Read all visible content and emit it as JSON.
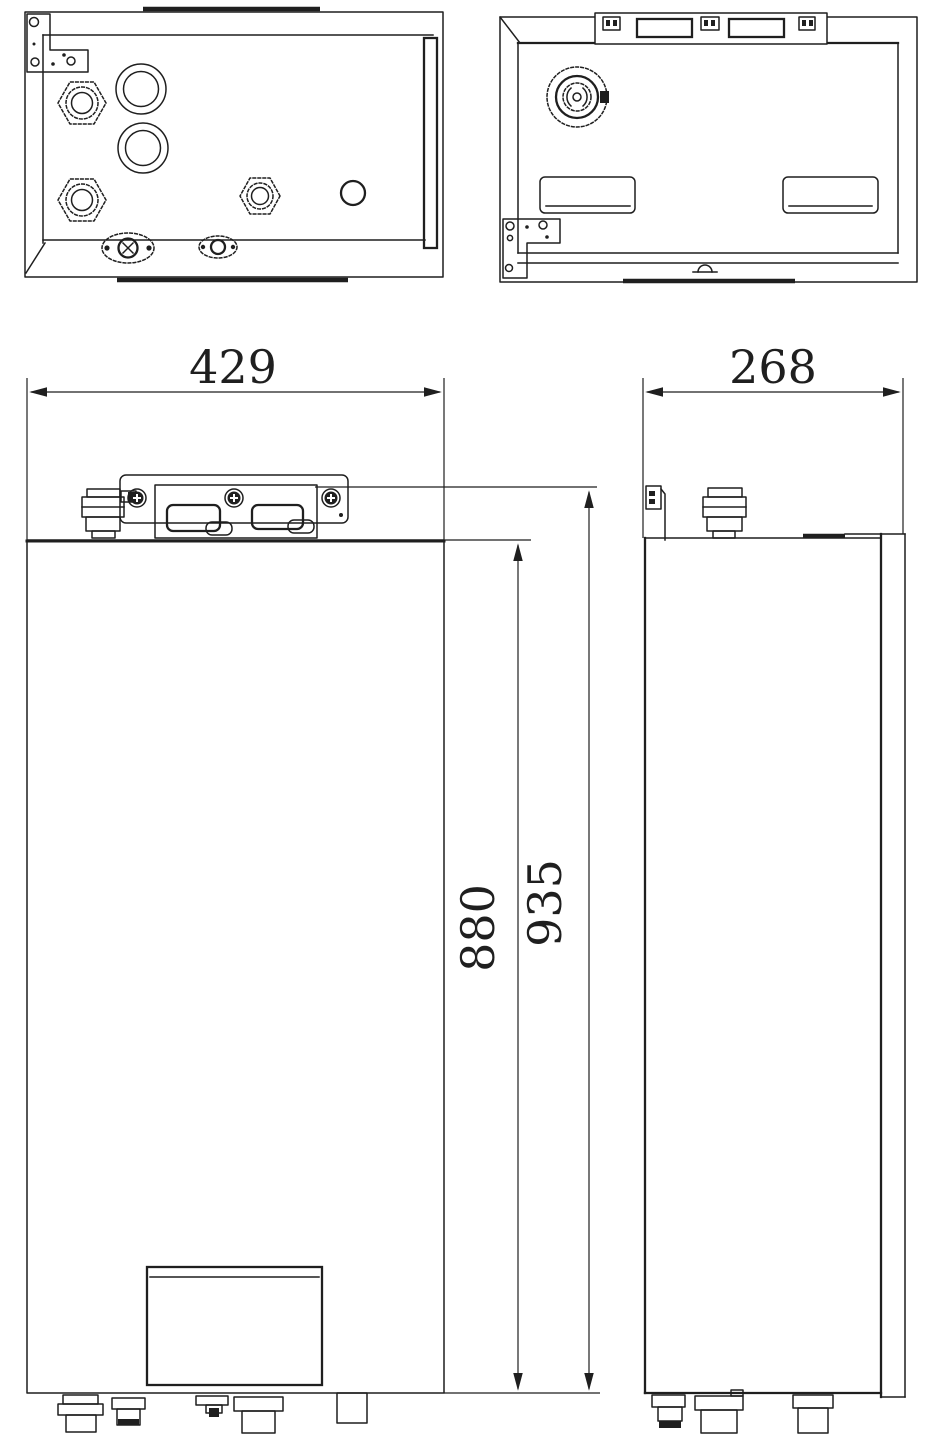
{
  "page": {
    "background": "#ffffff",
    "line_color": "#1f1f1f",
    "text_color": "#1f1f1f"
  },
  "dimensions": {
    "front_width": "429",
    "side_depth": "268",
    "body_height": "880",
    "overall_height": "935"
  }
}
